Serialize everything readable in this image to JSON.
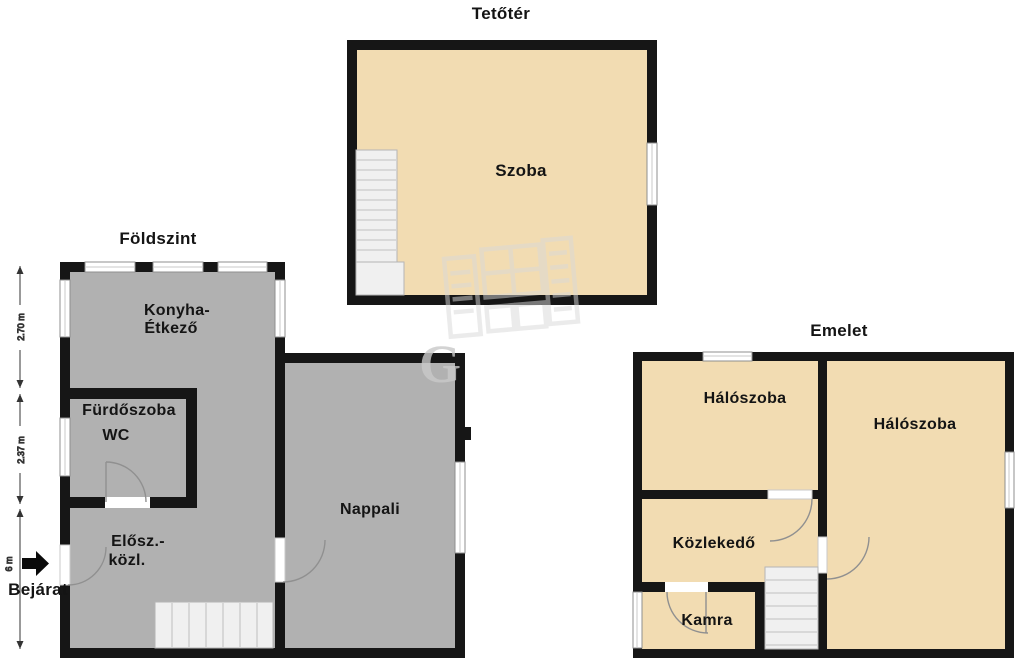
{
  "titles": {
    "attic": "Tetőtér",
    "ground": "Földszint",
    "upper": "Emelet"
  },
  "attic": {
    "room_label": "Szoba"
  },
  "ground": {
    "kitchen_line1": "Konyha-",
    "kitchen_line2": "Étkező",
    "bathroom_line1": "Fürdőszoba",
    "bathroom_line2": "WC",
    "hallway_line1": "Elősz.-",
    "hallway_line2": "közl.",
    "living_room": "Nappali",
    "entrance_label": "Bejárat"
  },
  "upper": {
    "bedroom_left": "Hálószoba",
    "bedroom_right": "Hálószoba",
    "corridor": "Közlekedő",
    "pantry": "Kamra"
  },
  "dimensions": {
    "d1": "2.70 m",
    "d2": "2.37 m",
    "d3": "6 m"
  },
  "watermark": {
    "letter": "G"
  },
  "colors": {
    "wall": "#161616",
    "room_gray": "#b1b1b1",
    "room_tan": "#f2dcb2",
    "stair_fill": "#f0f0f0",
    "frame_gray": "#8f8f8f",
    "arc_gray": "#909090",
    "background": "#ffffff",
    "text": "#141414",
    "watermark_gray": "#d9d9d9"
  }
}
